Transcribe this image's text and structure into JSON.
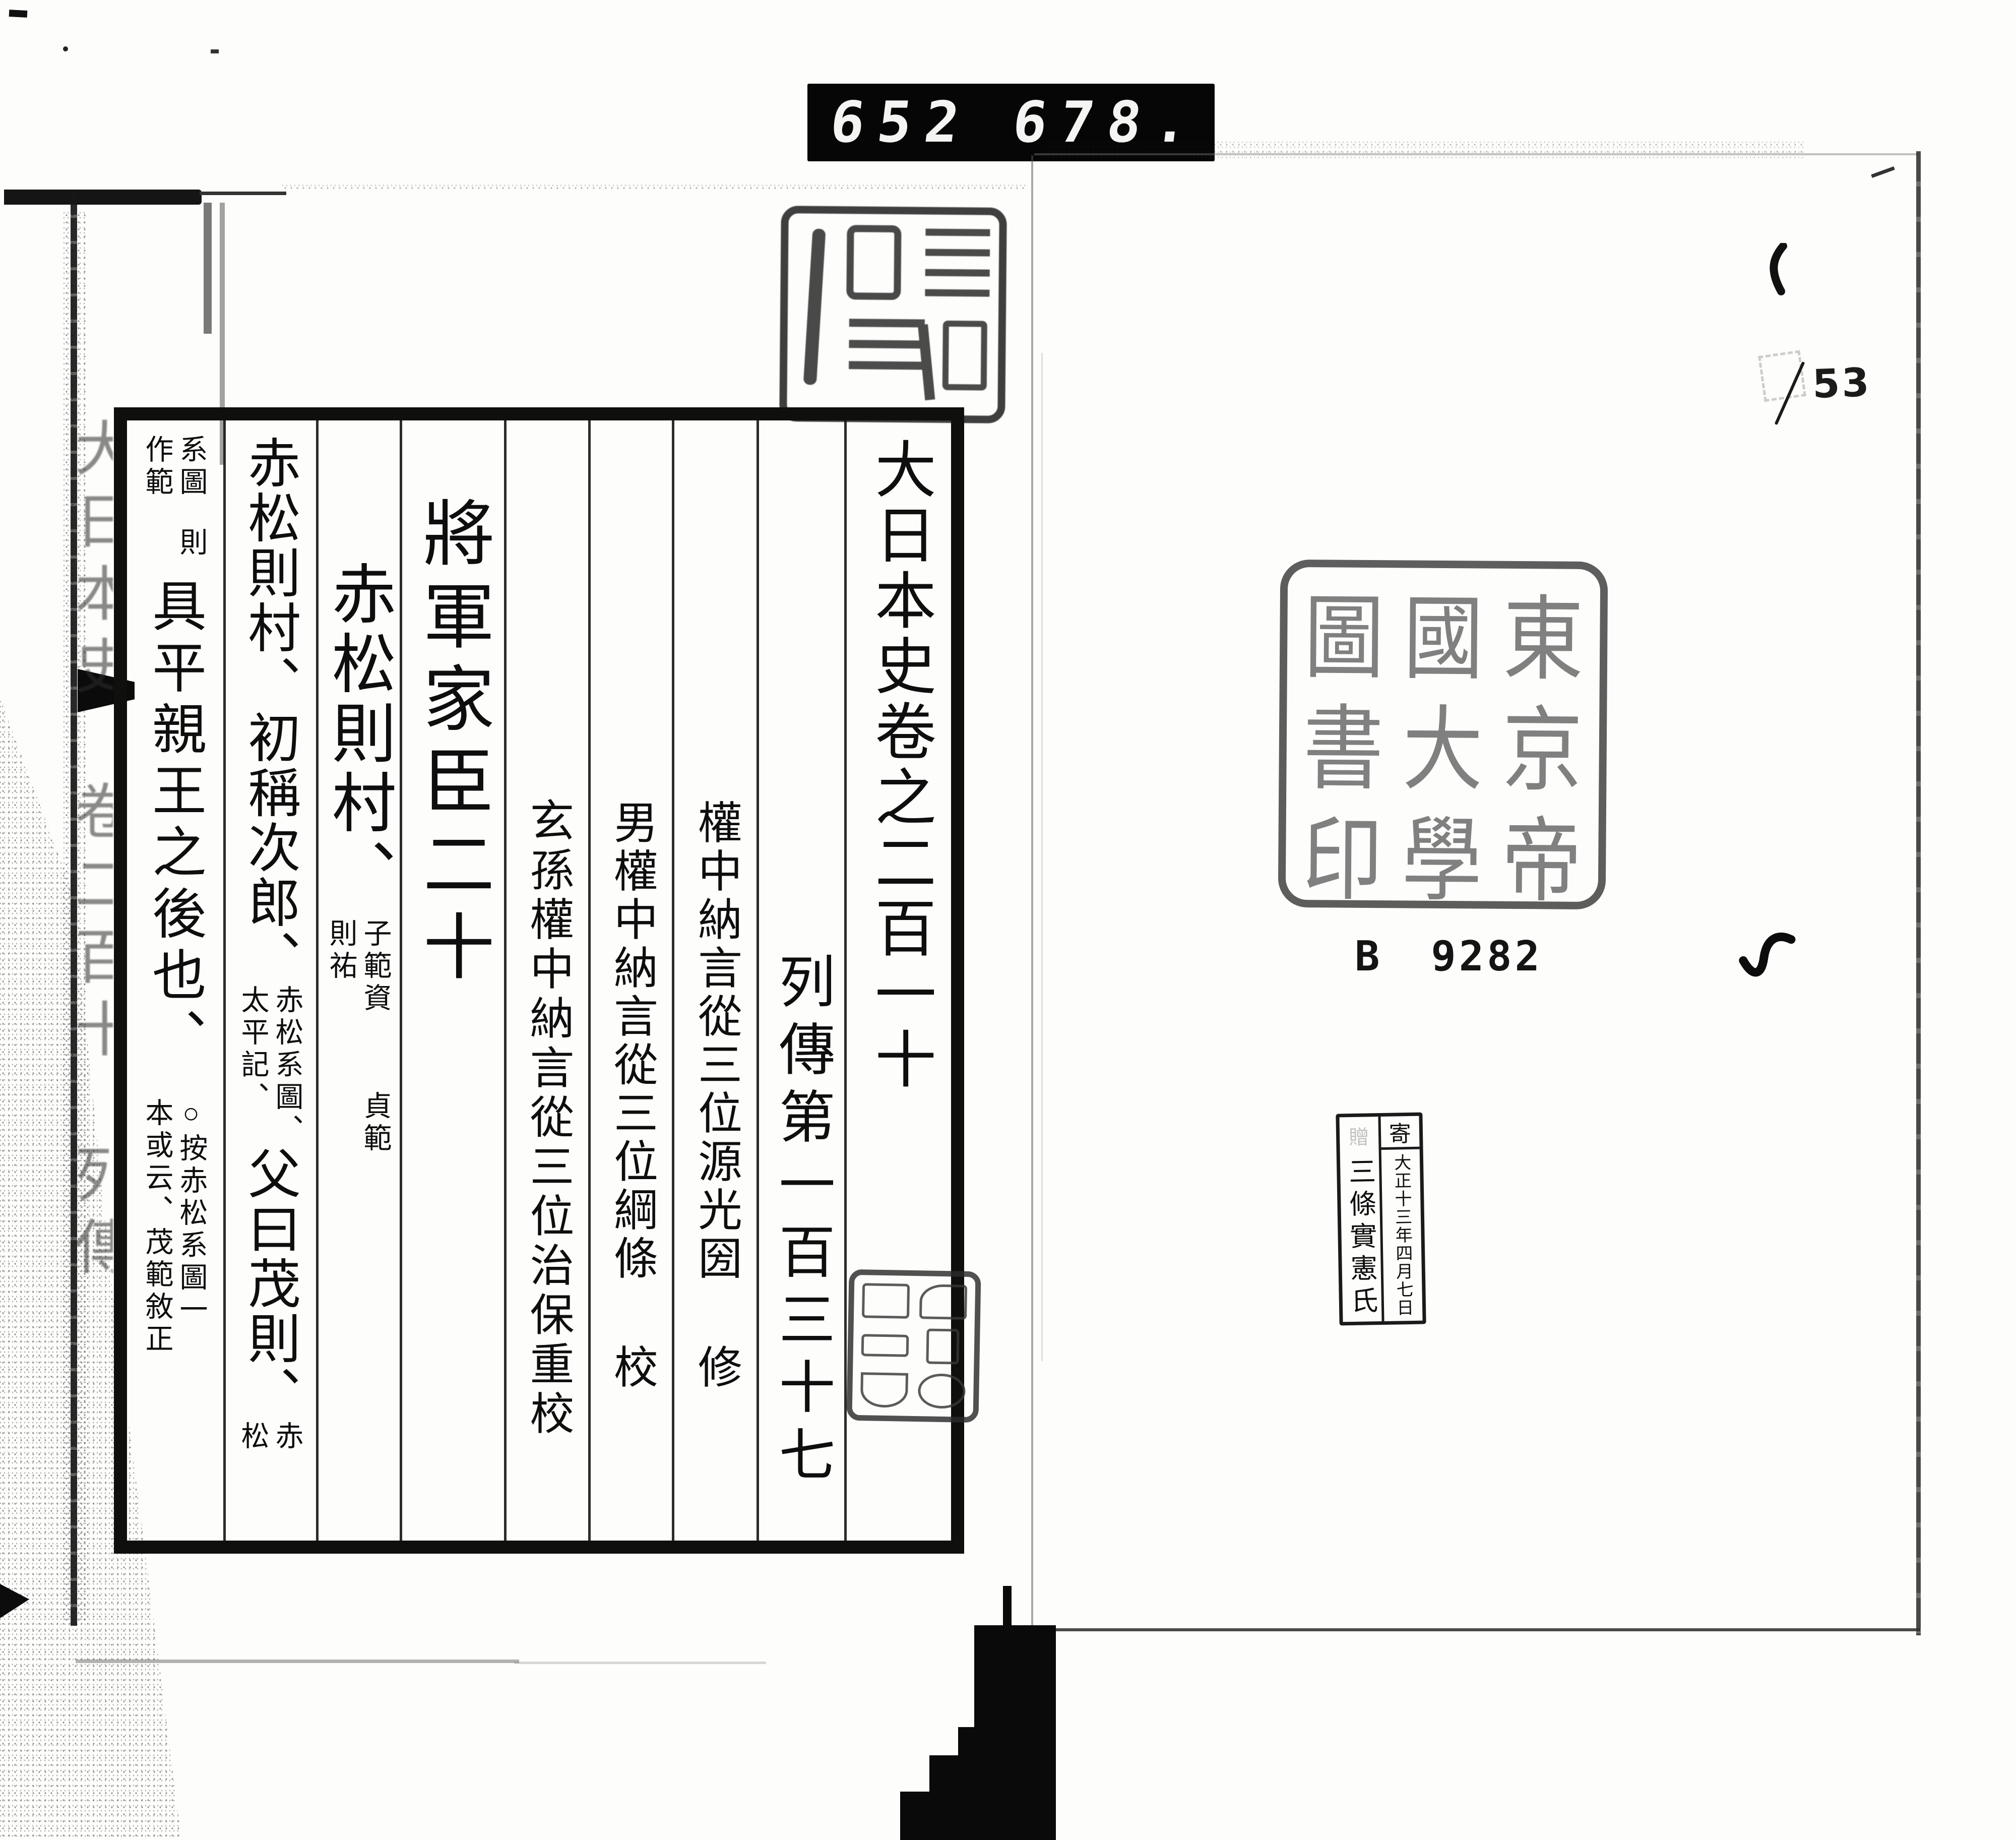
{
  "film_counter": {
    "left_value": "652",
    "right_value": "678."
  },
  "left_page": {
    "spine_label": "大日本史　卷二百十　列傳",
    "title_column": "大日本史卷之二百一十",
    "section_column": "列傳第一百三十七",
    "compilers": [
      {
        "name": "權中納言從三位源光圀",
        "role": "修"
      },
      {
        "name": "男權中納言從三位綱條",
        "role": "校"
      },
      {
        "name": "玄孫權中納言從三位治保重校",
        "role": ""
      }
    ],
    "chapter_heading": "將軍家臣二十",
    "subject": {
      "main": "赤松則村、",
      "children_note_right_1": "子範資",
      "children_note_right_2": "貞範",
      "children_note_left": "則祐"
    },
    "body": {
      "line1_main": "赤松則村、初稱次郎、",
      "line1_note_right": "赤松系圖、",
      "line1_note_left": "太平記、",
      "line1_main2": "父曰茂則、",
      "line1_note2_right": "赤",
      "line1_note2_left": "松",
      "line2_note_right_a": "系圖",
      "line2_note_right_b": "則",
      "line2_note_left": "作範",
      "line2_main": "具平親王之後也、",
      "line2_note2_right": "○按赤松系圖一",
      "line2_note2_left": "本或云、茂範敘正"
    },
    "header_seal_label": "faded seal impression (illegible seal script)"
  },
  "right_page": {
    "page_number": "53",
    "library_seal_text": "東京帝國大學圖書印",
    "library_seal_cells_rows": [
      [
        "圖",
        "國",
        "東"
      ],
      [
        "書",
        "大",
        "京"
      ],
      [
        "印",
        "學",
        "帝"
      ]
    ],
    "shelf_mark": {
      "prefix": "B",
      "number": "9282"
    },
    "donation_stamp": {
      "header": "寄",
      "header_faint": "贈",
      "date_line": "大正十三年四月七日",
      "name_line": "三條實憲氏"
    },
    "gutter_seal_label": "seal script (illegible)"
  }
}
